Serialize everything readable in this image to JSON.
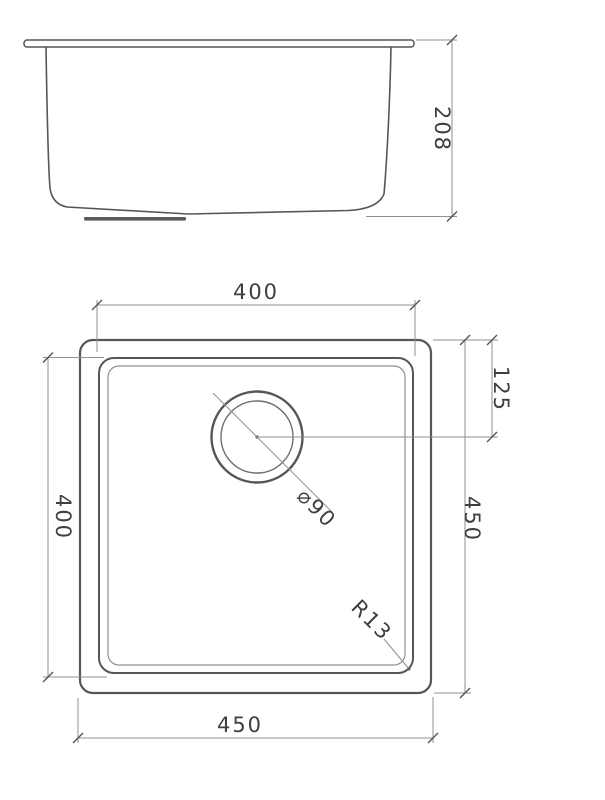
{
  "drawing": {
    "background_color": "#ffffff",
    "line_color": "#565656",
    "dim_line_color": "#8f8f8f",
    "text_color": "#3f3f3f",
    "side_view": {
      "description": "sink side elevation",
      "dims": {
        "height": {
          "value": 208,
          "label": "208"
        }
      }
    },
    "plan_view": {
      "description": "sink plan (top) view",
      "dims": {
        "inner_width_top": {
          "value": 400,
          "label": "400"
        },
        "drain_offset": {
          "value": 125,
          "label": "125"
        },
        "inner_height_left": {
          "value": 400,
          "label": "400"
        },
        "outer_height_right": {
          "value": 450,
          "label": "450"
        },
        "drain_diameter": {
          "value": 90,
          "label": "⌀90"
        },
        "corner_radius": {
          "value": 13,
          "label": "R13"
        },
        "outer_width_bottom": {
          "value": 450,
          "label": "450"
        }
      }
    }
  }
}
